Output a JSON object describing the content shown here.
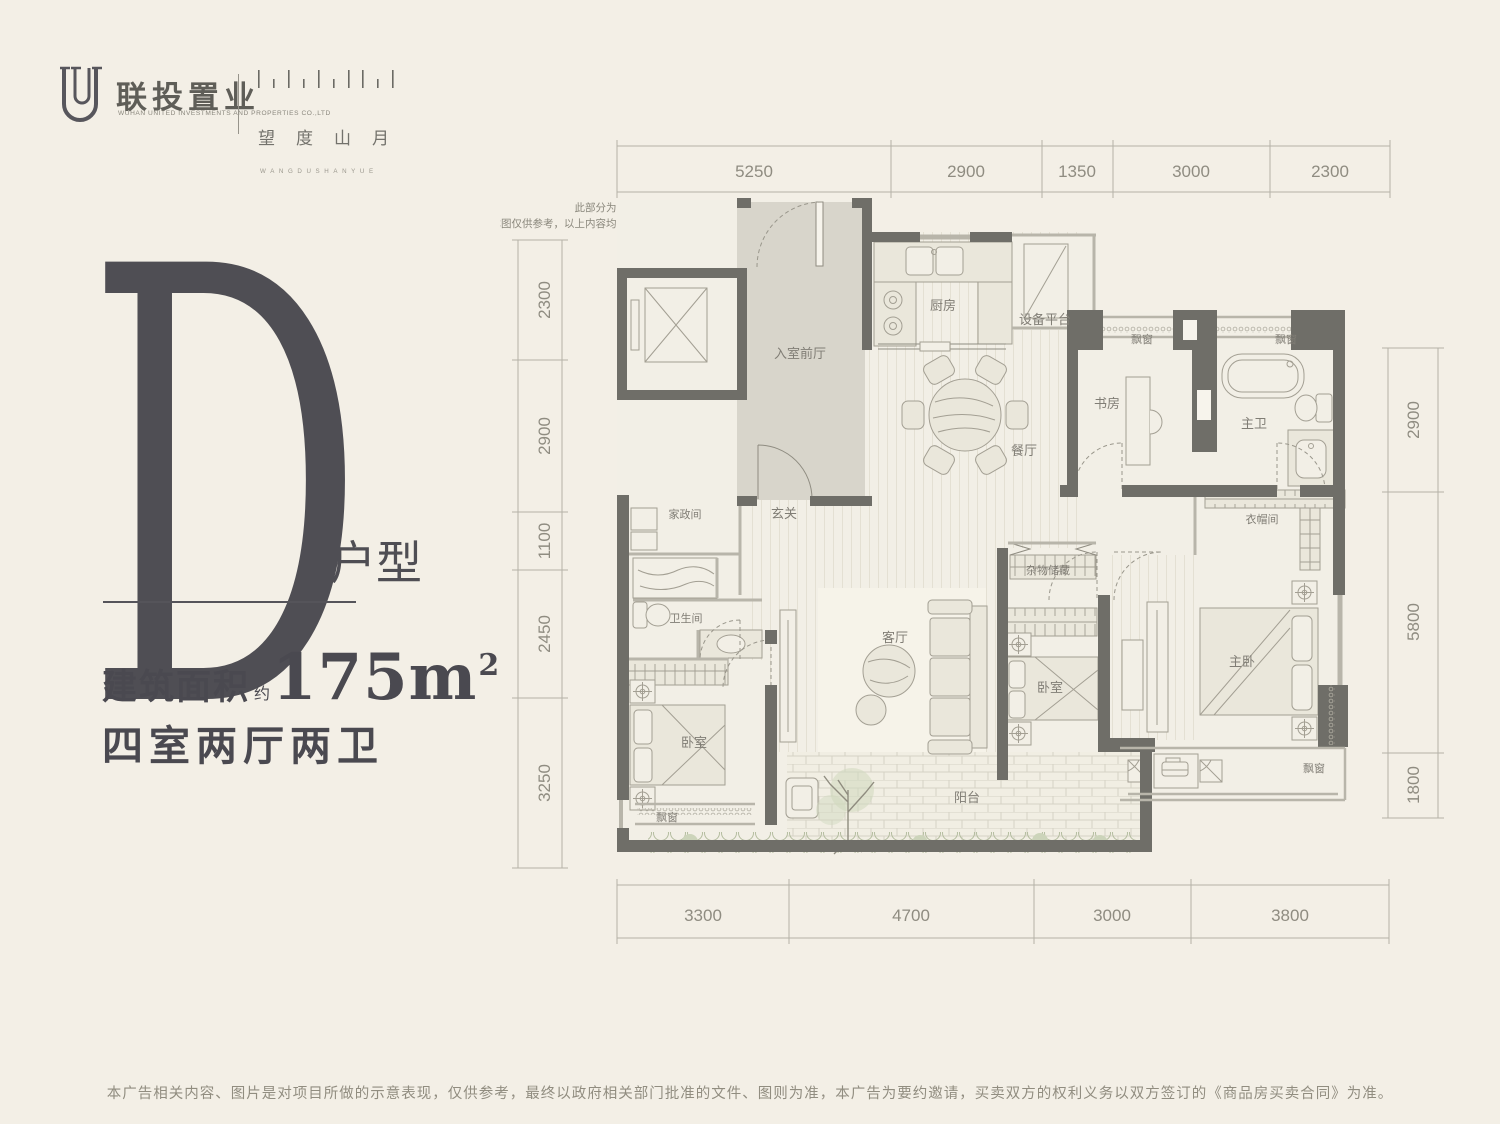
{
  "brand": {
    "name_cn": "联投置业",
    "name_en": "WUHAN UNITED INVESTMENTS AND PROPERTIES CO.,LTD",
    "project_cn": "望度山月",
    "project_en": "WANGDUSHANYUE"
  },
  "unit": {
    "letter": "D",
    "type_label": "户型",
    "area_prefix": "建筑面积",
    "area_approx": "约",
    "area_value": "175m",
    "area_sup": "2",
    "layout": "四室两厅两卫"
  },
  "plan": {
    "note_line1": "此部分为公共区域，不计入销售面积。",
    "note_line2": "本图仅供参考，以上内容均以合同及实际交付标准为准。",
    "dims_top": [
      "5250",
      "2900",
      "1350",
      "3000",
      "2300"
    ],
    "dims_bottom": [
      "3300",
      "4700",
      "3000",
      "3800"
    ],
    "dims_left": [
      "2300",
      "2900",
      "1100",
      "2450",
      "3250"
    ],
    "dims_right": [
      "2900",
      "5800",
      "1800"
    ],
    "rooms": {
      "entry": "入室前厅",
      "kitchen": "厨房",
      "equipment": "设备平台",
      "dining": "餐厅",
      "study": "书房",
      "master_bath": "主卫",
      "bay1": "飘窗",
      "bay2": "飘窗",
      "housekeeping": "家政间",
      "foyer": "玄关",
      "bathroom": "卫生间",
      "living": "客厅",
      "storage": "杂物储藏",
      "closet": "衣帽间",
      "bedroom1": "卧室",
      "bedroom2": "卧室",
      "master_bedroom": "主卧",
      "bay3": "飘窗",
      "bay4": "飘窗",
      "balcony": "阳台"
    }
  },
  "footer": {
    "disclaimer": "本广告相关内容、图片是对项目所做的示意表现，仅供参考，最终以政府相关部门批准的文件、图则为准，本广告为要约邀请，买卖双方的权利义务以双方签订的《商品房买卖合同》为准。"
  },
  "colors": {
    "background": "#f3efe6",
    "wall": "#6f6e68",
    "accent_dark": "#4f4e54",
    "dim_text": "#8f8c81"
  }
}
